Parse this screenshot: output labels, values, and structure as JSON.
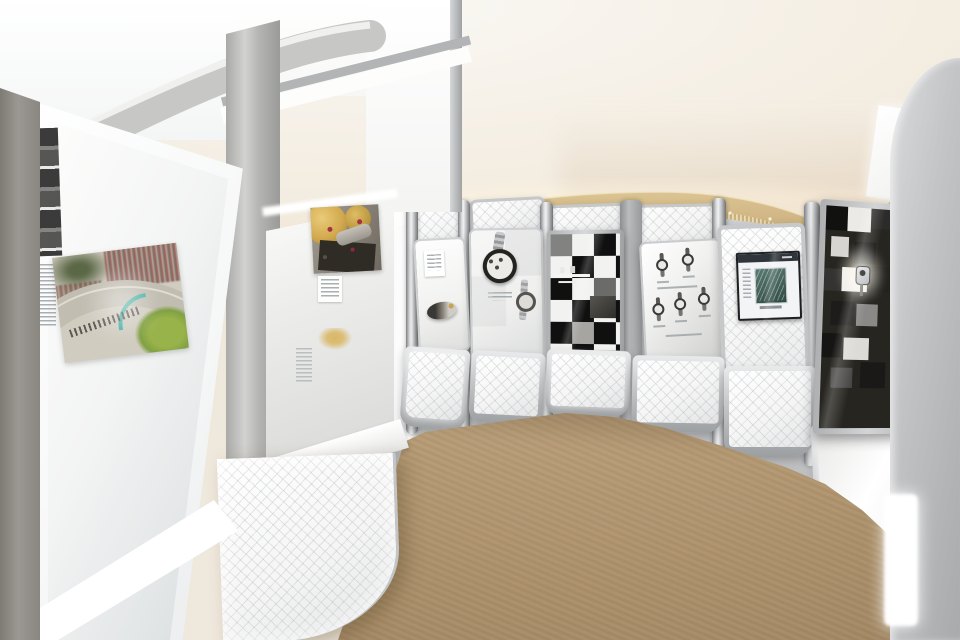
{
  "scene": {
    "title": "Watch exhibition gallery interior",
    "description": "Curved exhibition room lined with illuminated grey display modules showing wristwatches, a black-and-white checkered display case, an embedded video screen and a large backlit panel with a motor-racing circuit photograph; cream domed ceiling with a gold fringe light band; beige carpet floor."
  },
  "palette": {
    "ceiling_cream": "#f3ece0",
    "ceiling_pink": "#ecdccb",
    "gold_band": "#c9ab72",
    "fringe_light": "#e6d3a2",
    "metal_light": "#e9eaeb",
    "metal_mid": "#aeb0b2",
    "metal_dark": "#8b8d8f",
    "panel_glow": "#ffffff",
    "carpet": "#b59a74",
    "carpet_shadow": "#a2875f",
    "case_black": "#121212",
    "case_white": "#f2f2f0",
    "grass_green": "#85a93c",
    "curb_teal": "#3bb8ac",
    "movement_gold": "#d2a94e",
    "jewel_red": "#a5323e",
    "screen_page": "#f2f4f6"
  },
  "elements": {
    "ceiling": {
      "label": "Cream domed ceiling"
    },
    "gold_band": {
      "label": "Gold band with hanging light fringe"
    },
    "wall": {
      "label": "Curved wall of metallic display modules"
    },
    "left_panel": {
      "label": "Large backlit exhibit panel"
    },
    "racetrack_photo": {
      "label": "Photograph of motor racing circuit with crowds and green infield"
    },
    "film_strip": {
      "label": "Black-and-white photo strip"
    },
    "caption_text": {
      "label": "Small printed caption text (illegible)"
    },
    "movement_panel": {
      "label": "Shadowed exhibit panel with gold watch movement photograph"
    },
    "movement_photo": {
      "label": "Close-up photo of gold watch movement with red jewels"
    },
    "gold_emblem": {
      "label": "Small gold emblem print"
    },
    "watch_panel_a": {
      "label": "Lit panel with watch lying on its side and label card"
    },
    "watch_panel_b": {
      "label": "Panel with large chronograph and small bracelet watch"
    },
    "checkered_case": {
      "label": "Black-and-white checkered glass display case"
    },
    "watch_grid_panel": {
      "label": "Panel with five small wristwatches in two rows"
    },
    "screen_panel": {
      "label": "Quilted metal panel with embedded video screen"
    },
    "right_case": {
      "label": "Dark display case with checkered tiles and spotlit wristwatch"
    },
    "right_pillar": {
      "label": "Tall curved grey pillar"
    },
    "carpet": {
      "label": "Beige carpet floor"
    },
    "base_panels": {
      "label": "Illuminated quilted base panels"
    }
  }
}
